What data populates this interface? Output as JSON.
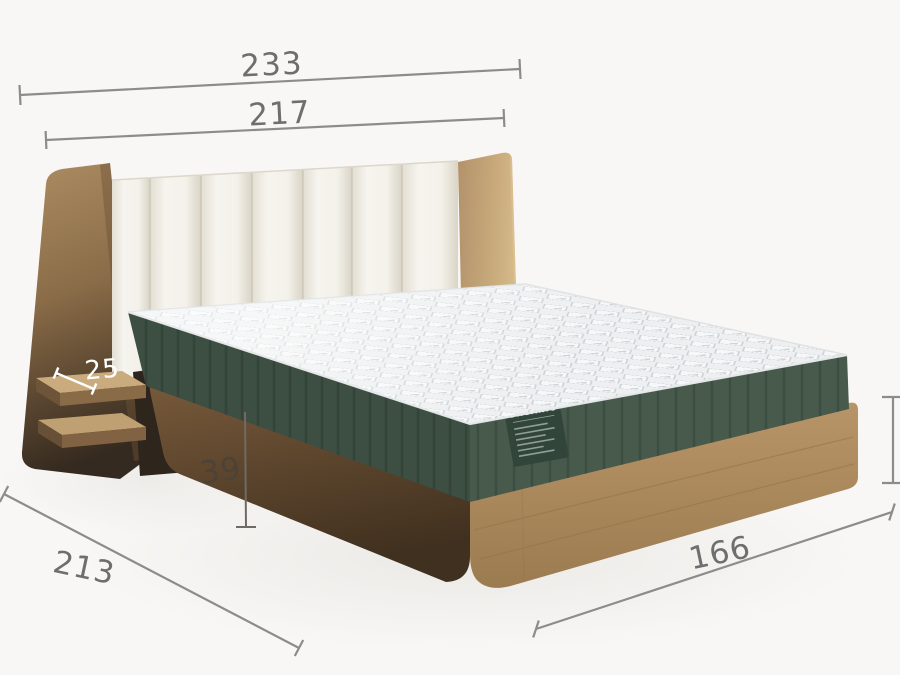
{
  "diagram": {
    "type": "product-dimension-diagram",
    "product": "bed-with-upholstered-headboard-wood-frame-and-mattress",
    "dimensions": {
      "overall_width": "233",
      "headboard_width": "217",
      "shelf_depth": "25",
      "frame_height": "39",
      "bed_length": "213",
      "bed_width": "166"
    },
    "mattress_label": {
      "title": "ORGANIC"
    },
    "colors": {
      "background": "#f8f7f5",
      "dimension_line": "#8c8c8c",
      "dimension_text": "#6e6e6e",
      "dimension_text_light": "#ffffff",
      "dimension_text_dark": "#4a4239",
      "wood_light": "#b89568",
      "wood_dark": "#5a4630",
      "upholstery_white": "#f2f0e9",
      "mattress_top": "#eef0f0",
      "mattress_side_green": "#44564a",
      "label_green": "#32453a"
    }
  }
}
